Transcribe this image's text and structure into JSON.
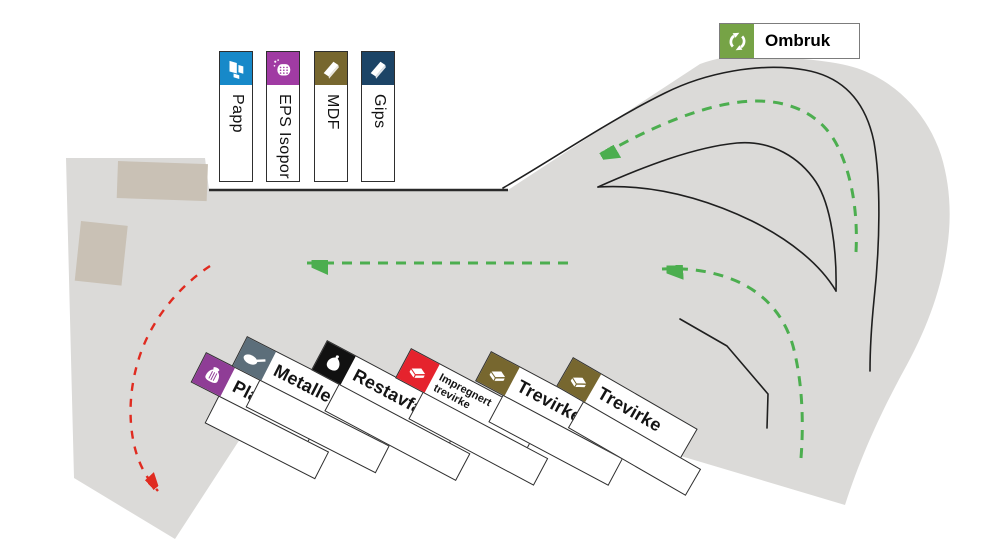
{
  "colors": {
    "site_area": "#dbdad8",
    "building": "#c9c1b5",
    "flow_green": "#4cae4f",
    "flow_red": "#e02b20",
    "road_line": "#1f1f1f"
  },
  "reuse_station": {
    "label": "Ombruk",
    "color": "#76a346",
    "icon": "recycle-icon"
  },
  "top_stations": [
    {
      "label": "Papp",
      "color": "#1789c9",
      "icon": "cardboard-icon",
      "x": 219,
      "y": 51
    },
    {
      "label": "EPS Isopor",
      "color": "#a03ba3",
      "icon": "foam-icon",
      "x": 266,
      "y": 51
    },
    {
      "label": "MDF",
      "color": "#77672f",
      "icon": "board-icon",
      "x": 314,
      "y": 51
    },
    {
      "label": "Gips",
      "color": "#1c4466",
      "icon": "board-icon",
      "x": 361,
      "y": 51
    }
  ],
  "bottom_stations": [
    {
      "label": "Plast",
      "color": "#8f3d96",
      "icon": "bag-icon",
      "x": 206,
      "y": 352,
      "angle": 27,
      "text_w": 100,
      "small": false
    },
    {
      "label": "Metaller",
      "color": "#5c6e7a",
      "icon": "pan-icon",
      "x": 247,
      "y": 336,
      "angle": 27,
      "text_w": 122,
      "small": false
    },
    {
      "label": "Restavfall",
      "color": "#111111",
      "icon": "trashbag-icon",
      "x": 327,
      "y": 340,
      "angle": 28,
      "text_w": 125,
      "small": false
    },
    {
      "label": "Impregnert\ntrevirke",
      "color": "#e5232d",
      "icon": "planks-icon",
      "x": 411,
      "y": 348,
      "angle": 28,
      "text_w": 118,
      "small": true
    },
    {
      "label": "Trevirke",
      "color": "#77672f",
      "icon": "planks-icon",
      "x": 491,
      "y": 351,
      "angle": 28,
      "text_w": 112,
      "small": false
    },
    {
      "label": "Trevirke",
      "color": "#77672f",
      "icon": "planks-icon",
      "x": 573,
      "y": 357,
      "angle": 30,
      "text_w": 112,
      "small": false
    }
  ],
  "flows": [
    {
      "id": "inbound-loop-top",
      "style": "dashed",
      "color_key": "flow_green",
      "direction": "curves from right side over the top loop, pointing left"
    },
    {
      "id": "main-lane-westbound",
      "style": "dashed",
      "color_key": "flow_green",
      "direction": "straight lane pointing left"
    },
    {
      "id": "inbound-lower-right",
      "style": "dashed",
      "color_key": "flow_green",
      "direction": "curves up from bottom right, pointing left"
    },
    {
      "id": "exit-southwest",
      "style": "dashed",
      "color_key": "flow_red",
      "direction": "curves down to bottom left exit"
    }
  ]
}
